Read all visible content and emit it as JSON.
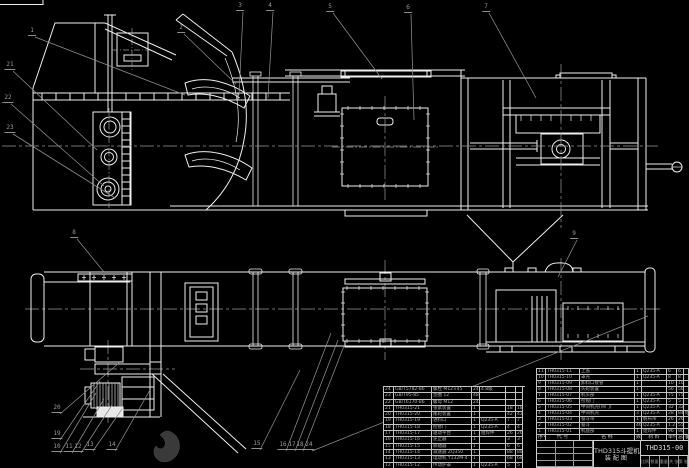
{
  "drawing": {
    "kind": "CAD engineering drawing - bucket elevator general assembly",
    "colors": {
      "background": "#000000",
      "line": "#efefef",
      "centerline": "#9a9a9a",
      "leader": "#8f8f8f",
      "table_line": "#c4c4c4",
      "table_text": "#b2b2b2",
      "watermark": "#3a3a3a"
    }
  },
  "title_block": {
    "product": "THD315斗提机",
    "view_label": "装配图",
    "drawing_number": "THD315-00",
    "fields": [
      "比例",
      "数量",
      "重量",
      "共 张",
      "第 张"
    ]
  },
  "bom_header": [
    "序号",
    "代 号",
    "名 称",
    "数量",
    "材 料",
    "单件",
    "总计",
    "备注"
  ],
  "bom_right": [
    {
      "no": "11",
      "code": "TH0315-11",
      "name": "上盖",
      "qty": "1",
      "mat": "Q235-A",
      "unit": "6",
      "total": "6",
      "rem": ""
    },
    {
      "no": "10",
      "code": "TH0315-10",
      "name": "罩壳",
      "qty": "1",
      "mat": "Q235-A",
      "unit": "8",
      "total": "8",
      "rem": ""
    },
    {
      "no": "9",
      "code": "TH0315-09",
      "name": "卸料口接管",
      "qty": "1",
      "mat": "",
      "unit": "10",
      "total": "10",
      "rem": ""
    },
    {
      "no": "8",
      "code": "TH0315-08",
      "name": "头轮装置",
      "qty": "1",
      "mat": "",
      "unit": "56",
      "total": "56",
      "rem": ""
    },
    {
      "no": "7",
      "code": "TH0315-07",
      "name": "机头部",
      "qty": "1",
      "mat": "Q235-A",
      "unit": "75",
      "total": "75",
      "rem": ""
    },
    {
      "no": "6",
      "code": "TH0315-06",
      "name": "检视门",
      "qty": "1",
      "mat": "Q235-A",
      "unit": "5",
      "total": "5",
      "rem": ""
    },
    {
      "no": "5",
      "code": "TH0315-05",
      "name": "中间机壳(带门)",
      "qty": "1",
      "mat": "Q235-A",
      "unit": "32",
      "total": "32",
      "rem": ""
    },
    {
      "no": "4",
      "code": "TH0315-04",
      "name": "中间机壳",
      "qty": "3",
      "mat": "Q235-A",
      "unit": "28",
      "total": "84",
      "rem": "组焊"
    },
    {
      "no": "3",
      "code": "TH0315-03",
      "name": "畚斗带",
      "qty": "1",
      "mat": "帆布带",
      "unit": "26",
      "total": "26",
      "rem": ""
    },
    {
      "no": "2",
      "code": "TH0315-02",
      "name": "畚斗",
      "qty": "46",
      "mat": "Q235-A",
      "unit": "1.2",
      "total": "55",
      "rem": ""
    },
    {
      "no": "1",
      "code": "TH0315-01",
      "name": "机座部",
      "qty": "1",
      "mat": "组焊件",
      "unit": "96",
      "total": "96",
      "rem": ""
    }
  ],
  "bom_left": [
    {
      "no": "24",
      "code": "GB/T5782-86",
      "name": "螺栓 M12×45",
      "qty": "24",
      "mat": "4.8级",
      "unit": "",
      "total": ""
    },
    {
      "no": "23",
      "code": "GB/T95-85",
      "name": "垫圈 12",
      "qty": "48",
      "mat": "",
      "unit": "",
      "total": ""
    },
    {
      "no": "22",
      "code": "GB/T6170-86",
      "name": "螺母 M12",
      "qty": "24",
      "mat": "",
      "unit": "",
      "total": ""
    },
    {
      "no": "21",
      "code": "TH0315-21",
      "name": "张紧装置",
      "qty": "1",
      "mat": "",
      "unit": "18",
      "total": "18"
    },
    {
      "no": "20",
      "code": "TH0315-20",
      "name": "尾轮装置",
      "qty": "1",
      "mat": "",
      "unit": "42",
      "total": "42"
    },
    {
      "no": "19",
      "code": "TH0315-19",
      "name": "进料口",
      "qty": "1",
      "mat": "Q235-A",
      "unit": "7",
      "total": "7"
    },
    {
      "no": "18",
      "code": "TH0315-18",
      "name": "检修门",
      "qty": "1",
      "mat": "Q235-A",
      "unit": "4",
      "total": "4"
    },
    {
      "no": "17",
      "code": "TH0315-17",
      "name": "驱动平台",
      "qty": "1",
      "mat": "组焊件",
      "unit": "26",
      "total": "26"
    },
    {
      "no": "16",
      "code": "TH0315-16",
      "name": "逆止器",
      "qty": "1",
      "mat": "",
      "unit": "3",
      "total": "3"
    },
    {
      "no": "15",
      "code": "TH0315-15",
      "name": "联轴器",
      "qty": "1",
      "mat": "",
      "unit": "6",
      "total": "6"
    },
    {
      "no": "14",
      "code": "TH0315-14",
      "name": "减速器 ZQ350",
      "qty": "1",
      "mat": "",
      "unit": "88",
      "total": "88"
    },
    {
      "no": "13",
      "code": "TH0315-13",
      "name": "电动机 Y132M-4",
      "qty": "1",
      "mat": "",
      "unit": "68",
      "total": "68"
    },
    {
      "no": "12",
      "code": "TH0315-12",
      "name": "传动护罩",
      "qty": "1",
      "mat": "Q235-A",
      "unit": "5",
      "total": "5"
    }
  ],
  "balloons": [
    {
      "n": "1",
      "x": 32,
      "y": 33,
      "lx": 185,
      "ly": 95
    },
    {
      "n": "2",
      "x": 181,
      "y": 30,
      "lx": 236,
      "ly": 84
    },
    {
      "n": "3",
      "x": 240,
      "y": 8,
      "lx": 239,
      "ly": 95
    },
    {
      "n": "4",
      "x": 270,
      "y": 8,
      "lx": 268,
      "ly": 98
    },
    {
      "n": "5",
      "x": 330,
      "y": 9,
      "lx": 382,
      "ly": 79
    },
    {
      "n": "6",
      "x": 408,
      "y": 10,
      "lx": 414,
      "ly": 120
    },
    {
      "n": "7",
      "x": 486,
      "y": 9,
      "lx": 536,
      "ly": 98
    },
    {
      "n": "21",
      "x": 10,
      "y": 67,
      "lx": 97,
      "ly": 150
    },
    {
      "n": "22",
      "x": 8,
      "y": 100,
      "lx": 104,
      "ly": 186
    },
    {
      "n": "23",
      "x": 10,
      "y": 130,
      "lx": 115,
      "ly": 198
    },
    {
      "n": "8",
      "x": 74,
      "y": 235,
      "lx": 104,
      "ly": 272
    },
    {
      "n": "9",
      "x": 574,
      "y": 236,
      "lx": 558,
      "ly": 277
    },
    {
      "n": "20",
      "x": 57,
      "y": 410,
      "lx": 120,
      "ly": 362
    },
    {
      "n": "19",
      "x": 57,
      "y": 436,
      "lx": 100,
      "ly": 381
    },
    {
      "n": "10",
      "x": 57,
      "y": 449,
      "lx": 96,
      "ly": 393
    },
    {
      "n": "11",
      "x": 69,
      "y": 449,
      "lx": 104,
      "ly": 399
    },
    {
      "n": "12",
      "x": 78,
      "y": 449,
      "lx": 112,
      "ly": 405
    },
    {
      "n": "13",
      "x": 90,
      "y": 447,
      "lx": 122,
      "ly": 409
    },
    {
      "n": "14",
      "x": 112,
      "y": 447,
      "lx": 150,
      "ly": 390
    },
    {
      "n": "15",
      "x": 257,
      "y": 446,
      "lx": 300,
      "ly": 370
    },
    {
      "n": "16",
      "x": 283,
      "y": 447,
      "lx": 331,
      "ly": 333
    },
    {
      "n": "17",
      "x": 292,
      "y": 447,
      "lx": 338,
      "ly": 340
    },
    {
      "n": "18",
      "x": 300,
      "y": 447,
      "lx": 344,
      "ly": 346
    },
    {
      "n": "24",
      "x": 309,
      "y": 447,
      "lx": 648,
      "ly": 316
    }
  ]
}
